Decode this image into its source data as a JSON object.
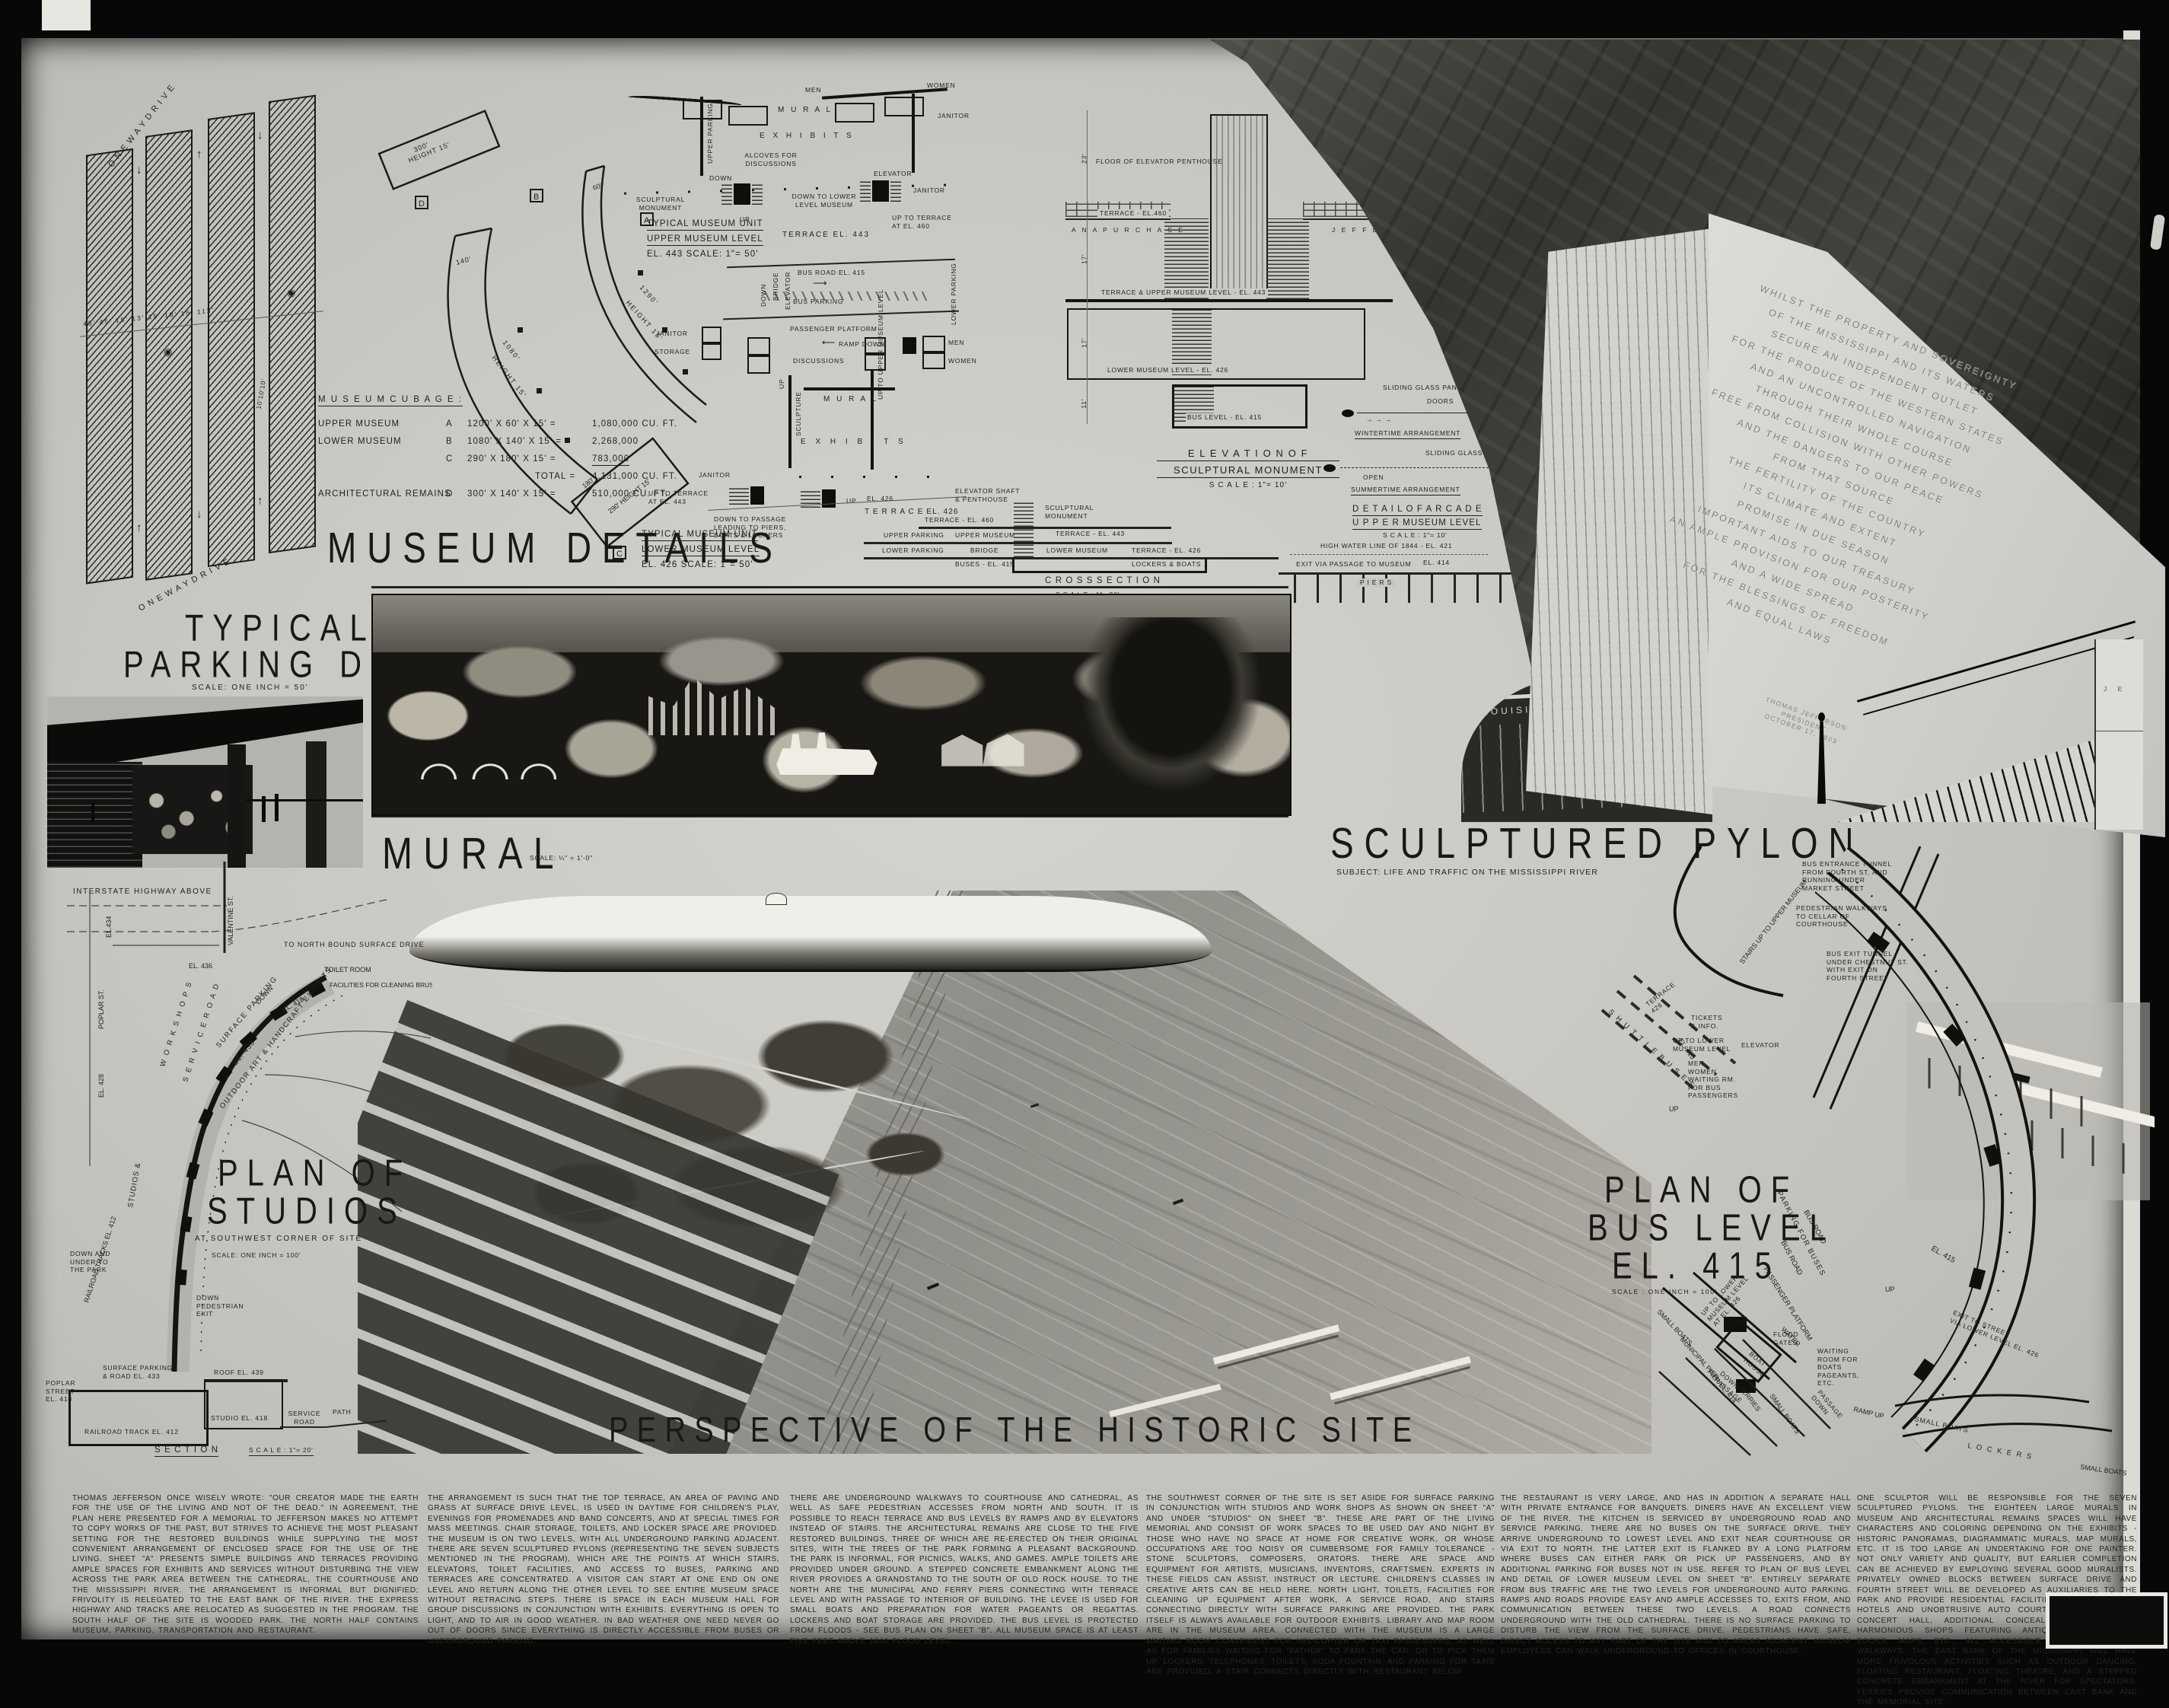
{
  "titles": {
    "museum_details": "MUSEUM  DETAILS",
    "typical_parking_1": "TYPICAL",
    "typical_parking_2": "PARKING DETAIL",
    "typical_parking_scale": "SCALE:  ONE  INCH = 50'",
    "mural": "MURAL",
    "mural_scale": "SCALE:  ¼\" = 1'-0\"",
    "sculptured_pylon": "SCULPTURED  PYLON",
    "pylon_subject": "SUBJECT:  LIFE  AND  TRAFFIC  ON  THE  MISSISSIPPI  RIVER",
    "perspective": "PERSPECTIVE  OF  THE  HISTORIC  SITE",
    "plan_studios_1": "PLAN OF",
    "plan_studios_2": "STUDIOS",
    "plan_studios_sub": "AT SOUTHWEST CORNER OF SITE",
    "plan_studios_scale": "SCALE: ONE INCH = 100'",
    "plan_bus_1": "PLAN OF",
    "plan_bus_2": "BUS LEVEL",
    "plan_bus_3": "EL. 415",
    "plan_bus_scale": "SCALE : ONE INCH = 100'"
  },
  "parking_detail": {
    "one_way_top": "O N E   W A Y   D R I V E",
    "one_way_bottom": "O N E   W A Y   D R I V E",
    "dims": "45'      45'    15' 13' 15' 18' 15' 113'",
    "stall_dim": "10'10'10'"
  },
  "museum_cubage": {
    "heading": "M U S E U M     C U B A G E :",
    "rows": [
      {
        "name": "UPPER   MUSEUM",
        "key": "A",
        "dims": "1200' X 60' X 15' =",
        "value": "1,080,000  CU. FT."
      },
      {
        "name": "LOWER   MUSEUM",
        "key": "B",
        "dims": "1080' X 140' X 15' =",
        "value": "2,268,000"
      },
      {
        "name": "",
        "key": "C",
        "dims": "290' X 180' X 15' =",
        "value": "783,000"
      },
      {
        "name": "",
        "key": "",
        "dims": "TOTAL =",
        "value": "4,131,000  CU. FT."
      },
      {
        "name": "ARCHITECTURAL REMAINS",
        "key": "D",
        "dims": "300' X 140' X 15' =",
        "value": "510,000  CU. FT."
      }
    ]
  },
  "segments": {
    "labels": [
      "D",
      "300'",
      "HEIGHT 15'",
      "B",
      "140'",
      "1080'",
      "HEIGHT 15'",
      "A",
      "60'",
      "1290'",
      "HEIGHT 15'",
      "C",
      "180'",
      "290'  HEIGHT 15'"
    ]
  },
  "unit_plans": {
    "upper_title": [
      "TYPICAL  MUSEUM  UNIT",
      "UPPER  MUSEUM  LEVEL",
      "EL. 443        SCALE:  1\"= 50'"
    ],
    "lower_title": [
      "TYPICAL  MUSEUM  UNIT",
      "LOWER  MUSEUM  LEVEL",
      "EL. 426        SCALE:  1\"= 50'"
    ],
    "labels": [
      "MEN",
      "WOMEN",
      "JANITOR",
      "M U R A L",
      "E X H I B I T S",
      "ALCOVES  FOR\nDISCUSSIONS",
      "UPPER PARKING",
      "DOWN",
      "SCULPTURAL\nMONUMENT",
      "ELEVATOR",
      "JANITOR",
      "DOWN TO LOWER\nLEVEL MUSEUM",
      "UP",
      "UP TO TERRACE\nAT EL. 460",
      "TERRACE  EL. 443",
      "BUS  ROAD  EL. 415",
      "BUS  PARKING",
      "PASSENGER  PLATFORM",
      "RAMP  DOWN",
      "BRIDGE",
      "ELEVATOR",
      "DOWN",
      "LOWER PARKING",
      "JANITOR",
      "STORAGE",
      "DISCUSSIONS",
      "MEN",
      "WOMEN",
      "SCULPTURE",
      "UP",
      "M U R A L",
      "E X H I B I T S",
      "UP TO UPPER\nMUSEUM LEVEL",
      "JANITOR",
      "UP TO TERRACE\nAT EL. 443",
      "DOWN TO PASSAGE\nLEADING TO PIERS,\nBOATS & LOCKERS",
      "UP",
      "T E R R A C E   EL.  426"
    ]
  },
  "elevation": {
    "title": [
      "E L E V A T I O N     O F",
      "SCULPTURAL   MONUMENT",
      "S C A L E :   1\"= 10'"
    ],
    "labels": [
      "FLOOR  OF  ELEVATOR  PENTHOUSE",
      "TERRACE - EL.460",
      "A N A    P U R C H A S E",
      "J  E  F  F  E",
      "TERRACE  &  UPPER   MUSEUM  LEVEL - EL. 443",
      "LOWER   MUSEUM   LEVEL - EL. 426",
      "BUS   LEVEL - EL. 415",
      "23'",
      "17'",
      "17'",
      "11'"
    ]
  },
  "glass_details": {
    "labels": [
      "SLIDING  GLASS  PANELS",
      "DOORS",
      "COLUMN",
      "WINTERTIME   ARRANGEMENT",
      "OPEN",
      "SLIDING  GLASS  PANELS",
      "COLUMN",
      "SUMMERTIME   ARRANGEMENT"
    ],
    "arcade_title": [
      "D E T A I L   O F   A R C A D E",
      "U P P E R    MUSEUM   LEVEL",
      "S C A L E :  1\"= 10'"
    ]
  },
  "cross_section": {
    "title": [
      "C R O S S    S E C T I O N",
      "S C A L E :  1\"= 50'"
    ],
    "labels": [
      "EL. 426",
      "ELEVATOR  SHAFT\n&  PENTHOUSE",
      "SCULPTURAL\nMONUMENT",
      "TERRACE - EL. 460",
      "UPPER   PARKING",
      "UPPER  MUSEUM",
      "TERRACE - EL. 443",
      "LOWER  PARKING",
      "BRIDGE",
      "LOWER   MUSEUM",
      "BUSES - EL. 415",
      "TERRACE - EL. 426",
      "LOCKERS  &  BOATS",
      "HIGH WATER LINE  OF  1844 - EL. 421",
      "EXIT VIA  PASSAGE  TO MUSEUM",
      "EL. 414",
      "P  I  E  R  S"
    ]
  },
  "pylon": {
    "inscription": [
      "WHILST  THE  PROPERTY  AND  SOVEREIGNTY",
      "OF  THE  MISSISSIPPI  AND  ITS  WATERS",
      "SECURE  AN  INDEPENDENT  OUTLET",
      "FOR  THE  PRODUCE  OF  THE  WESTERN  STATES",
      "AND  AN  UNCONTROLLED  NAVIGATION",
      "THROUGH  THEIR  WHOLE  COURSE",
      "FREE  FROM  COLLISION  WITH  OTHER  POWERS",
      "AND  THE  DANGERS  TO  OUR  PEACE",
      "FROM  THAT  SOURCE",
      "THE  FERTILITY  OF  THE  COUNTRY",
      "ITS  CLIMATE  AND  EXTENT",
      "PROMISE  IN  DUE  SEASON",
      "IMPORTANT  AIDS  TO  OUR  TREASURY",
      "AN  AMPLE  PROVISION  FOR  OUR  POSTERITY",
      "AND  A  WIDE  SPREAD",
      "FOR  THE  BLESSINGS  OF  FREEDOM",
      "AND  EQUAL  LAWS"
    ],
    "signature": "THOMAS  JEFFERSON\nPRESIDENT\nOCTOBER 17, 1803",
    "stadium_text": "LOUISIANA  PURCHASE",
    "right_building_text": "J  E"
  },
  "plan_studios": {
    "labels": [
      "INTERSTATE  HIGHWAY  ABOVE",
      "EL.434",
      "EL. 436",
      "VALENTINE  ST.",
      "POPLAR  ST.",
      "EL. 428",
      "TO  NORTH  BOUND  SURFACE  DRIVE",
      "SURFACE  PARKING",
      "EL. 433",
      "DOWN",
      "EL. 418",
      "TOILET  ROOM",
      "FACILITIES FOR\nCLEANING BRUSHES,\nETC., AFTER WORK",
      "W O R K   S H O P S",
      "S E R V I C E   R O A D",
      "STUDIOS  &",
      "OUTDOOR  ART  &  HANDCRAFT  EXHIBITS",
      "RAILROAD  TRACKS  EL. 412",
      "DOWN\nPEDESTRIAN\nEXIT",
      "DOWN AND\nUNDER TO\nTHE PARK",
      "POPLAR\nSTREET\nEL. 418"
    ],
    "section_labels": [
      "SURFACE  PARKING\n& ROAD  EL. 433",
      "ROOF  EL. 439",
      "STUDIO  EL. 418",
      "SERVICE\nROAD",
      "PATH",
      "RAILROAD   TRACK   EL. 412",
      "S E C T I O N",
      "S C A L E :  1\"= 20'"
    ]
  },
  "plan_bus": {
    "labels": [
      "BUS ENTRANCE  TUNNEL\nFROM  FOURTH  ST. AND\nRUNNING  UNDER\nMARKET  STREET",
      "PEDESTRIAN  WALKWAYS\nTO  CELLAR  OF\nCOURTHOUSE",
      "BUS  EXIT  TUNNEL\nUNDER  CHESTNUT  ST.\nWITH  EXIT  ON\nFOURTH  STREET",
      "STAIRS UP TO\nUPPER MUSEUM",
      "S H U T T L E   B U S E S",
      "EL. 415",
      "TERRACE\n426",
      "UP",
      "TICKETS\n& INFO.",
      "UP TO LOWER\nMUSEUM LEVEL",
      "ELEVATOR",
      "MEN\nWOMEN\nWAITING RM.\nFOR BUS\nPASSENGERS",
      "PARKING  FOR  BUSES",
      "BUS  ROAD",
      "BUS  ROAD",
      "PASSENGER  PLATFORM",
      "EL. 415",
      "EXIT TO STREET\nVIA LOWER LEVEL EL. 426",
      "UP TO LOWER\nMUSEUM LEVEL\nAT EL. 426",
      "FLOOD\nGATES",
      "BOAT\nHOUSE",
      "DOWN\nPASSAGE",
      "UP",
      "WATER",
      "SMALL BOATS",
      "MUNICIPAL PIER",
      "PIER EL. 414",
      "FERRIES",
      "SMALL BOATS",
      "PASSAGE\nDOWN",
      "WAITING\nROOM FOR\nBOATS\nPAGEANTS,\nETC.",
      "SMALL  BOATS",
      "RAMP UP",
      "L O C K E R S",
      "SMALL BOATS",
      "UP"
    ]
  },
  "text_columns": [
    "THOMAS JEFFERSON ONCE WISELY WROTE: \"OUR CREATOR MADE THE EARTH FOR THE USE OF THE LIVING AND NOT OF THE DEAD.\" IN AGREEMENT, THE PLAN HERE PRESENTED FOR A MEMORIAL TO JEFFERSON MAKES NO ATTEMPT TO COPY WORKS OF THE PAST, BUT STRIVES TO ACHIEVE THE MOST PLEASANT SETTING FOR THE RESTORED BUILDINGS WHILE SUPPLYING THE MOST CONVENIENT ARRANGEMENT OF ENCLOSED SPACE FOR THE USE OF THE LIVING. SHEET \"A\" PRESENTS SIMPLE BUILDINGS AND TERRACES PROVIDING AMPLE SPACES FOR EXHIBITS AND SERVICES WITHOUT DISTURBING THE VIEW ACROSS THE PARK AREA BETWEEN THE CATHEDRAL, THE COURTHOUSE AND THE MISSISSIPPI RIVER. THE ARRANGEMENT IS INFORMAL BUT DIGNIFIED; FRIVOLITY IS RELEGATED TO THE EAST BANK OF THE RIVER. THE EXPRESS HIGHWAY AND TRACKS ARE RELOCATED AS SUGGESTED IN THE PROGRAM. THE SOUTH HALF OF THE SITE IS WOODED PARK. THE NORTH HALF CONTAINS MUSEUM, PARKING, TRANSPORTATION AND RESTAURANT.",
    "THE ARRANGEMENT IS SUCH THAT THE TOP TERRACE, AN AREA OF PAVING AND GRASS AT SURFACE DRIVE LEVEL, IS USED IN DAYTIME FOR CHILDREN'S PLAY, EVENINGS FOR PROMENADES AND BAND CONCERTS, AND AT SPECIAL TIMES FOR MASS MEETINGS. CHAIR STORAGE, TOILETS, AND LOCKER SPACE ARE PROVIDED. THE MUSEUM IS ON TWO LEVELS, WITH ALL UNDERGROUND PARKING ADJACENT. THERE ARE SEVEN SCULPTURED PYLONS (REPRESENTING THE SEVEN SUBJECTS MENTIONED IN THE PROGRAM), WHICH ARE THE POINTS AT WHICH STAIRS, ELEVATORS, TOILET FACILITIES, AND ACCESS TO BUSES, PARKING AND TERRACES ARE CONCENTRATED. A VISITOR CAN START AT ONE END ON ONE LEVEL AND RETURN ALONG THE OTHER LEVEL TO SEE ENTIRE MUSEUM SPACE WITHOUT RETRACING STEPS. THERE IS SPACE IN EACH MUSEUM HALL FOR GROUP DISCUSSIONS IN CONJUNCTION WITH EXHIBITS. EVERYTHING IS OPEN TO LIGHT, AND TO AIR IN GOOD WEATHER. IN BAD WEATHER ONE NEED NEVER GO OUT OF DOORS SINCE EVERYTHING IS DIRECTLY ACCESSIBLE FROM BUSES OR UNDERGROUND PARKING.",
    "THERE ARE UNDERGROUND WALKWAYS TO COURTHOUSE AND CATHEDRAL, AS WELL AS SAFE PEDESTRIAN ACCESSES FROM NORTH AND SOUTH. IT IS POSSIBLE TO REACH TERRACE AND BUS LEVELS BY RAMPS AND BY ELEVATORS INSTEAD OF STAIRS. THE ARCHITECTURAL REMAINS ARE CLOSE TO THE FIVE RESTORED BUILDINGS, THREE OF WHICH ARE RE-ERECTED ON THEIR ORIGINAL SITES, WITH THE TREES OF THE PARK FORMING A PLEASANT BACKGROUND. THE PARK IS INFORMAL, FOR PICNICS, WALKS, AND GAMES. AMPLE TOILETS ARE PROVIDED UNDER GROUND. A STEPPED CONCRETE EMBANKMENT ALONG THE RIVER PROVIDES A GRANDSTAND TO THE SOUTH OF OLD ROCK HOUSE. TO THE NORTH ARE THE MUNICIPAL AND FERRY PIERS CONNECTING WITH TERRACE LEVEL AND WITH PASSAGE TO INTERIOR OF BUILDING. THE LEVEE IS USED FOR SMALL BOATS AND PREPARATION FOR WATER PAGEANTS OR REGATTAS. LOCKERS AND BOAT STORAGE ARE PROVIDED. THE BUS LEVEL IS PROTECTED FROM FLOODS - SEE BUS PLAN ON SHEET \"B\". ALL MUSEUM SPACE IS AT LEAST FIVE FEET ABOVE 1844 FLOOD LEVEL.",
    "THE SOUTHWEST CORNER OF THE SITE IS SET ASIDE FOR SURFACE PARKING IN CONJUNCTION WITH STUDIOS AND WORK SHOPS AS SHOWN ON SHEET \"A\" AND UNDER \"STUDIOS\" ON SHEET \"B\". THESE ARE PART OF THE LIVING MEMORIAL AND CONSIST OF WORK SPACES TO BE USED DAY AND NIGHT BY THOSE WHO HAVE NO SPACE AT HOME FOR CREATIVE WORK, OR WHOSE OCCUPATIONS ARE TOO NOISY OR CUMBERSOME FOR FAMILY TOLERANCE - STONE SCULPTORS, COMPOSERS, ORATORS. THERE ARE SPACE AND EQUIPMENT FOR ARTISTS, MUSICIANS, INVENTORS, CRAFTSMEN. EXPERTS IN THESE FIELDS CAN ASSIST, INSTRUCT OR LECTURE. CHILDREN'S CLASSES IN CREATIVE ARTS CAN BE HELD HERE. NORTH LIGHT, TOILETS, FACILITIES FOR CLEANING UP EQUIPMENT AFTER WORK, A SERVICE ROAD, AND STAIRS CONNECTING DIRECTLY WITH SURFACE PARKING ARE PROVIDED. THE PARK ITSELF IS ALWAYS AVAILABLE FOR OUTDOOR EXHIBITS. LIBRARY AND MAP ROOM ARE IN THE MUSEUM AREA. CONNECTED WITH THE MUSEUM IS A LARGE WAITING ROOM CONVENIENT FOR HELICOPTER OR TAXI PASSENGERS, AS WELL AS FOR FAMILIES WAITING FOR \"FATHER\" TO PARK THE CAR, OR TO PICK THEM UP. LOCKERS, TELEPHONES, TOILETS, SODA FOUNTAIN, AND PARKING FOR TAXIS ARE PROVIDED. A STAIR CONNECTS DIRECTLY WITH RESTAURANT BELOW.",
    "THE RESTAURANT IS VERY LARGE, AND HAS IN ADDITION A SEPARATE HALL WITH PRIVATE ENTRANCE FOR BANQUETS. DINERS HAVE AN EXCELLENT VIEW OF THE RIVER. THE KITCHEN IS SERVICED BY UNDERGROUND ROAD AND SERVICE PARKING. THERE ARE NO BUSES ON THE SURFACE DRIVE. THEY ARRIVE UNDERGROUND TO LOWEST LEVEL AND EXIT NEAR COURTHOUSE OR VIA EXIT TO NORTH. THE LATTER EXIT IS FLANKED BY A LONG PLATFORM WHERE BUSES CAN EITHER PARK OR PICK UP PASSENGERS, AND BY ADDITIONAL PARKING FOR BUSES NOT IN USE. REFER TO PLAN OF BUS LEVEL AND DETAIL OF LOWER MUSEUM LEVEL ON SHEET \"B\". ENTIRELY SEPARATE FROM BUS TRAFFIC ARE THE TWO LEVELS FOR UNDERGROUND AUTO PARKING. RAMPS AND ROADS PROVIDE EASY AND AMPLE ACCESSES TO, EXITS FROM, AND COMMUNICATION BETWEEN THESE TWO LEVELS. A ROAD CONNECTS UNDERGROUND WITH THE OLD CATHEDRAL. THERE IS NO SURFACE PARKING TO DISTURB THE VIEW FROM THE SURFACE DRIVE. PEDESTRIANS HAVE SAFE, DIRECT ACCESS TO ANY PART OF THE SITE AND TO AREAS ADJACENT. MUSEUM EMPLOYEES CAN WALK UNDERGROUND TO OFFICES IN COURTHOUSE.",
    "ONE SCULPTOR WILL BE RESPONSIBLE FOR THE SEVEN SCULPTURED PYLONS. THE EIGHTEEN LARGE MURALS IN MUSEUM AND ARCHITECTURAL REMAINS SPACES WILL HAVE CHARACTERS AND COLORING DEPENDING ON THE EXHIBITS - HISTORIC PANORAMAS, DIAGRAMMATIC MURALS, MAP MURALS, ETC. IT IS TOO LARGE AN UNDERTAKING FOR ONE PAINTER. NOT ONLY VARIETY AND QUALITY, BUT EARLIER COMPLETION CAN BE ACHIEVED BY EMPLOYING SEVERAL GOOD MURALISTS. PRIVATELY OWNED BLOCKS BETWEEN SURFACE DRIVE AND FOURTH STREET WILL BE DEVELOPED AS AUXILIARIES TO THE PARK AND PROVIDE RESIDENTIAL FACILITIES (SUCH AS SMALL HOTELS AND UNOBTRUSIVE AUTO COURTS), ART GALLERIES, CONCERT HALL, ADDITIONAL CONCEALED PARKING, AND HARMONIOUS SHOPS FEATURING ANTIQUES, HANDCRAFTS, BOOKS, MAPS, ETC., ALL ACCESSIBLE BY UNDERGROUND WALKWAYS. THE EAST BANK OF THE MISSISSIPPI WILL HAVE MORE FRIVOLOUS ACTIVITIES SUCH AS OUTDOOR DANCING, FLOATING RESTAURANT, FLOATING THEATRE, AND A STEPPED CONCRETE EMBANKMENT AT THE RIVER FOR SPECTATORS. FERRIES PROVIDE COMMUNICATION BETWEEN EAST BANK AND THE MEMORIAL SITE."
  ]
}
